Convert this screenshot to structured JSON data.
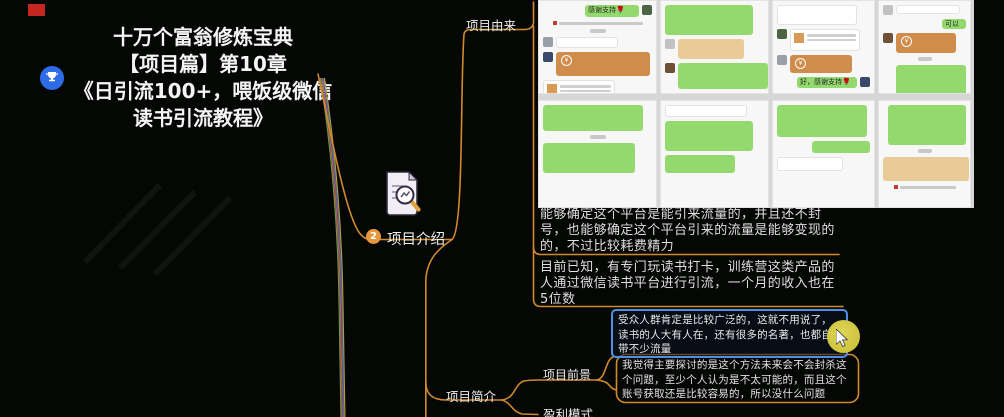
{
  "window": {
    "background": "#050705",
    "recording_marker_color": "#c3271f"
  },
  "root": {
    "icon": "trophy",
    "title_lines": [
      "十万个富翁修炼宝典",
      "【项目篇】第10章",
      "《日引流100+，喂饭级微信",
      "读书引流教程》"
    ]
  },
  "nodes": {
    "intro": {
      "badge": "2",
      "label": "项目介绍",
      "icon": "document-magnifier"
    },
    "origin": {
      "label": "项目由来"
    },
    "origin_texts": [
      "能够确定这个平台是能引来流量的，并且还不封号，也能够确定这个平台引来的流量是能够变现的的，不过比较耗费精力",
      "目前已知，有专门玩读书打卡，训练营这类产品的人通过微信读书平台进行引流，一个月的收入也在5位数"
    ],
    "brief": {
      "label": "项目简介"
    },
    "prospect": {
      "label": "项目前景"
    },
    "prospect_texts": {
      "audience": "受众人群肯定是比较广泛的，这就不用说了，读书的人大有人在，还有很多的名著，也都自带不少流量",
      "future": "我觉得主要探讨的是这个方法未来会不会封杀这个问题，至少个人认为是不太可能的，而且这个账号获取还是比较容易的，所以没什么问题"
    },
    "profit": {
      "label": "盈利模式"
    }
  },
  "colors": {
    "branch": "#cf8a2e",
    "selected_border": "#4f8fe8",
    "badge": "#e8963c",
    "root_icon_blue": "#2e6be6",
    "wechat_green": "#93d96e",
    "card_orange": "#cf8c4a",
    "card_tan": "#e8cb96",
    "highlight": "#d2c83e",
    "trunk_bundle": [
      "#6e9a48",
      "#c25c52",
      "#5a68b4",
      "#ad9f3e"
    ]
  },
  "collage": {
    "description": "wechat-chat-screenshot-grid",
    "panels": [
      {
        "row": 1,
        "w": 119,
        "bubbles": [
          {
            "s": "r",
            "c": "green",
            "w": 54,
            "h": 12,
            "t": "感谢支持🌹",
            "av": true
          },
          {
            "s": "c",
            "c": "sys",
            "w": 84,
            "h": 6
          },
          {
            "s": "c",
            "c": "time",
            "w": 16,
            "h": 4
          },
          {
            "s": "l",
            "c": "white",
            "w": 62,
            "h": 11,
            "av": true
          },
          {
            "s": "l",
            "c": "orange",
            "w": 94,
            "h": 24,
            "av": true
          },
          {
            "s": "l",
            "c": "invite",
            "w": 72,
            "h": 26
          }
        ]
      },
      {
        "row": 1,
        "w": 109,
        "bubbles": [
          {
            "s": "l",
            "c": "green",
            "w": 88,
            "h": 30
          },
          {
            "s": "l",
            "c": "tan",
            "w": 66,
            "h": 20,
            "av": true
          },
          {
            "s": "l",
            "c": "green",
            "w": 90,
            "h": 26,
            "av": true
          }
        ]
      },
      {
        "row": 1,
        "w": 103,
        "bubbles": [
          {
            "s": "l",
            "c": "white",
            "w": 80,
            "h": 20
          },
          {
            "s": "l",
            "c": "invite",
            "w": 70,
            "h": 22,
            "av": true
          },
          {
            "s": "l",
            "c": "orange",
            "w": 62,
            "h": 18,
            "av": true
          },
          {
            "s": "r",
            "c": "green",
            "w": 60,
            "h": 11,
            "t": "好，感谢支持🌹",
            "av": true
          }
        ]
      },
      {
        "row": 1,
        "w": 93,
        "bubbles": [
          {
            "s": "l",
            "c": "white",
            "w": 64,
            "h": 9,
            "av": true
          },
          {
            "s": "r",
            "c": "green",
            "w": 24,
            "h": 10,
            "t": "可以"
          },
          {
            "s": "l",
            "c": "orange",
            "w": 60,
            "h": 20,
            "av": true
          },
          {
            "s": "c",
            "c": "time",
            "w": 14,
            "h": 4
          },
          {
            "s": "r",
            "c": "green",
            "w": 70,
            "h": 32
          }
        ]
      },
      {
        "row": 2,
        "w": 119,
        "bubbles": [
          {
            "s": "l",
            "c": "green",
            "w": 100,
            "h": 26
          },
          {
            "s": "c",
            "c": "time",
            "w": 16,
            "h": 4
          },
          {
            "s": "l",
            "c": "green",
            "w": 92,
            "h": 30
          }
        ]
      },
      {
        "row": 2,
        "w": 109,
        "bubbles": [
          {
            "s": "l",
            "c": "white",
            "w": 82,
            "h": 12
          },
          {
            "s": "l",
            "c": "green",
            "w": 88,
            "h": 30
          },
          {
            "s": "l",
            "c": "green",
            "w": 70,
            "h": 18
          }
        ]
      },
      {
        "row": 2,
        "w": 103,
        "bubbles": [
          {
            "s": "l",
            "c": "green",
            "w": 90,
            "h": 32
          },
          {
            "s": "r",
            "c": "green",
            "w": 58,
            "h": 12
          },
          {
            "s": "l",
            "c": "white",
            "w": 66,
            "h": 14
          }
        ]
      },
      {
        "row": 2,
        "w": 93,
        "bubbles": [
          {
            "s": "r",
            "c": "green",
            "w": 78,
            "h": 40
          },
          {
            "s": "c",
            "c": "time",
            "w": 14,
            "h": 4
          },
          {
            "s": "l",
            "c": "tan",
            "w": 86,
            "h": 24
          },
          {
            "s": "c",
            "c": "sys",
            "w": 56,
            "h": 6
          }
        ]
      }
    ]
  }
}
